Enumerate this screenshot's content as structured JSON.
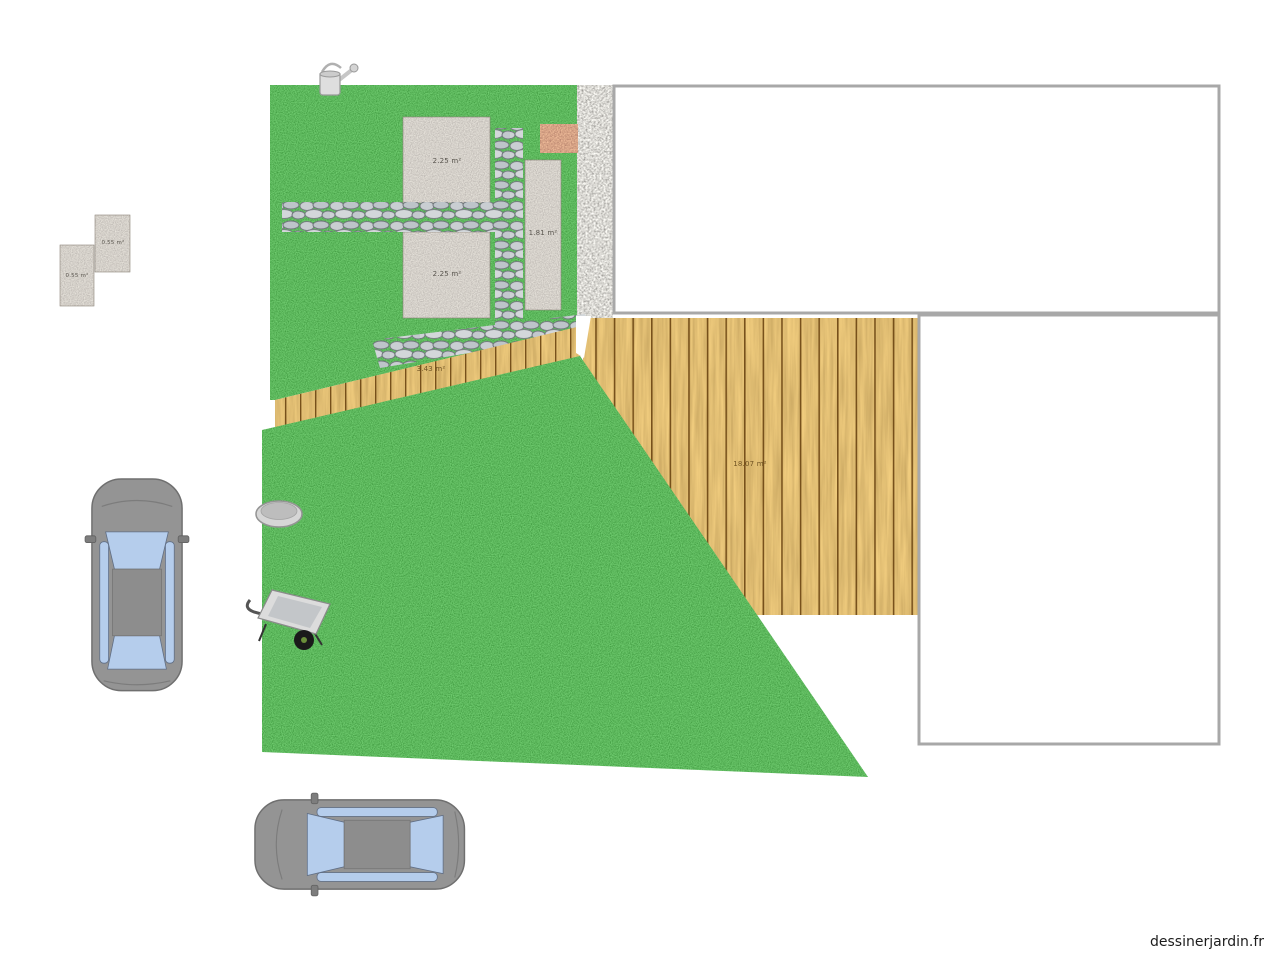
{
  "watermark": "dessinerjardin.fr",
  "areas": {
    "slab_top": "2.25 m²",
    "slab_bottom": "2.25 m²",
    "slab_tall": "1.81 m²",
    "small_slab_lower": "0.55 m²",
    "small_slab_upper": "0.55 m²",
    "wood_path": "3.43 m²",
    "deck": "18.07 m²"
  },
  "objects": {
    "lawn": "pelouse",
    "deck": "terrasse bois",
    "gravel_strip": "gravier",
    "stepping_stones": "pas japonais",
    "brick_patch": "briques",
    "buildings": [
      "maison",
      "annexe"
    ],
    "props": [
      "arrosoir",
      "vasque",
      "brouette",
      "voiture",
      "voiture"
    ]
  },
  "colors": {
    "grass": "#1d7a1d",
    "deck_wood": "#c0832b",
    "plank_line": "#6b4511",
    "gravel": "#b3afa7",
    "slab": "#a9a095",
    "brick": "#ad5f3d",
    "stone": "#c9ced2",
    "car_body": "#949494",
    "car_window": "#b5cdec",
    "building_border": "#a8a8a8"
  }
}
